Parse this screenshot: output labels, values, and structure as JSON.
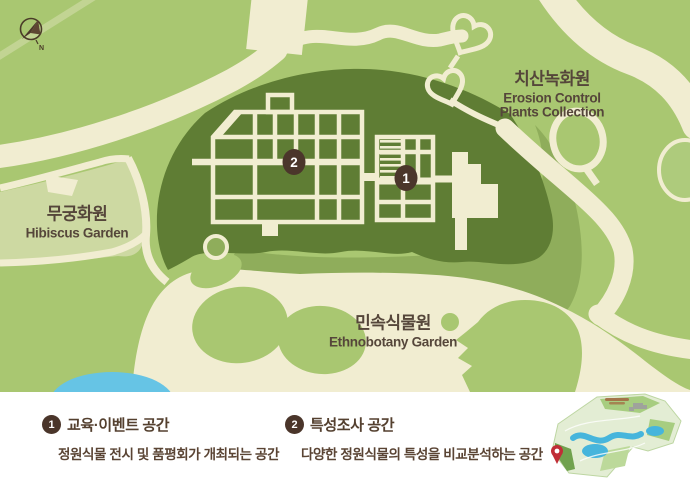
{
  "compass": {
    "north_label": "N"
  },
  "map": {
    "areas": [
      {
        "id": "erosion-control",
        "name_ko": "치산녹화원",
        "name_en_line1": "Erosion Control",
        "name_en_line2": "Plants Collection"
      },
      {
        "id": "hibiscus",
        "name_ko": "무궁화원",
        "name_en_line1": "Hibiscus Garden"
      },
      {
        "id": "ethnobotany",
        "name_ko": "민속식물원",
        "name_en_line1": "Ethnobotany Garden"
      }
    ],
    "markers": [
      {
        "number": "1"
      },
      {
        "number": "2"
      }
    ]
  },
  "legend": {
    "items": [
      {
        "number": "1",
        "title": "교육·이벤트 공간",
        "description": "정원식물 전시 및 품평회가 개최되는 공간"
      },
      {
        "number": "2",
        "title": "특성조사 공간",
        "description": "다양한 정원식물의 특성을 비교분석하는 공간"
      }
    ]
  },
  "colors": {
    "background_green": "#a9c771",
    "mid_green": "#8fad5b",
    "dark_green": "#5f7d34",
    "lawn_pale_green": "#cdd9a2",
    "path_cream": "#f1edd1",
    "label_brown": "#55463a",
    "marker_brown": "#4b362b",
    "pond_blue": "#66c4e5",
    "minimap_pin_red": "#c02e37",
    "legend_background": "#ffffff"
  }
}
